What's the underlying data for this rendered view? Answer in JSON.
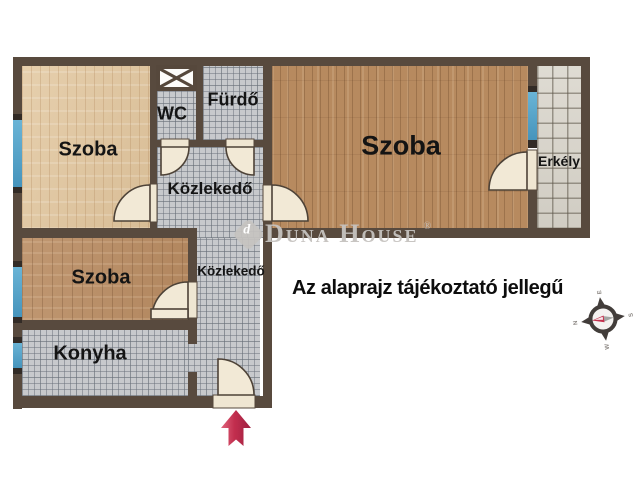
{
  "floor_plan": {
    "rooms": [
      {
        "id": "szoba-top-left",
        "label": "Szoba"
      },
      {
        "id": "wc",
        "label": "WC"
      },
      {
        "id": "furdo",
        "label": "Fürdő"
      },
      {
        "id": "kozlekedo-upper",
        "label": "Közlekedő"
      },
      {
        "id": "szoba-main",
        "label": "Szoba"
      },
      {
        "id": "erkely",
        "label": "Erkély"
      },
      {
        "id": "szoba-lower",
        "label": "Szoba"
      },
      {
        "id": "kozlekedo-lower",
        "label": "Közlekedő"
      },
      {
        "id": "konyha",
        "label": "Konyha"
      }
    ],
    "disclaimer": "Az alaprajz tájékoztató jellegű",
    "watermark": {
      "brand": "Duna House",
      "registered": "®"
    },
    "compass": {
      "north": "N",
      "east": "E",
      "south": "S",
      "west": "W"
    },
    "colors": {
      "wall": "#584a3e",
      "wood_light": "#e3c9a2",
      "wood_medium": "#b78a5f",
      "tile_gray": "#c7c9cc",
      "tile_balcony": "#d9d5cb",
      "window_blue": "#55a5ca",
      "door_cream": "#f2e9d6",
      "arrow_red": "#c22e4e",
      "watermark_gray": "#c5c2bf",
      "text_black": "#0d0d0d"
    }
  }
}
